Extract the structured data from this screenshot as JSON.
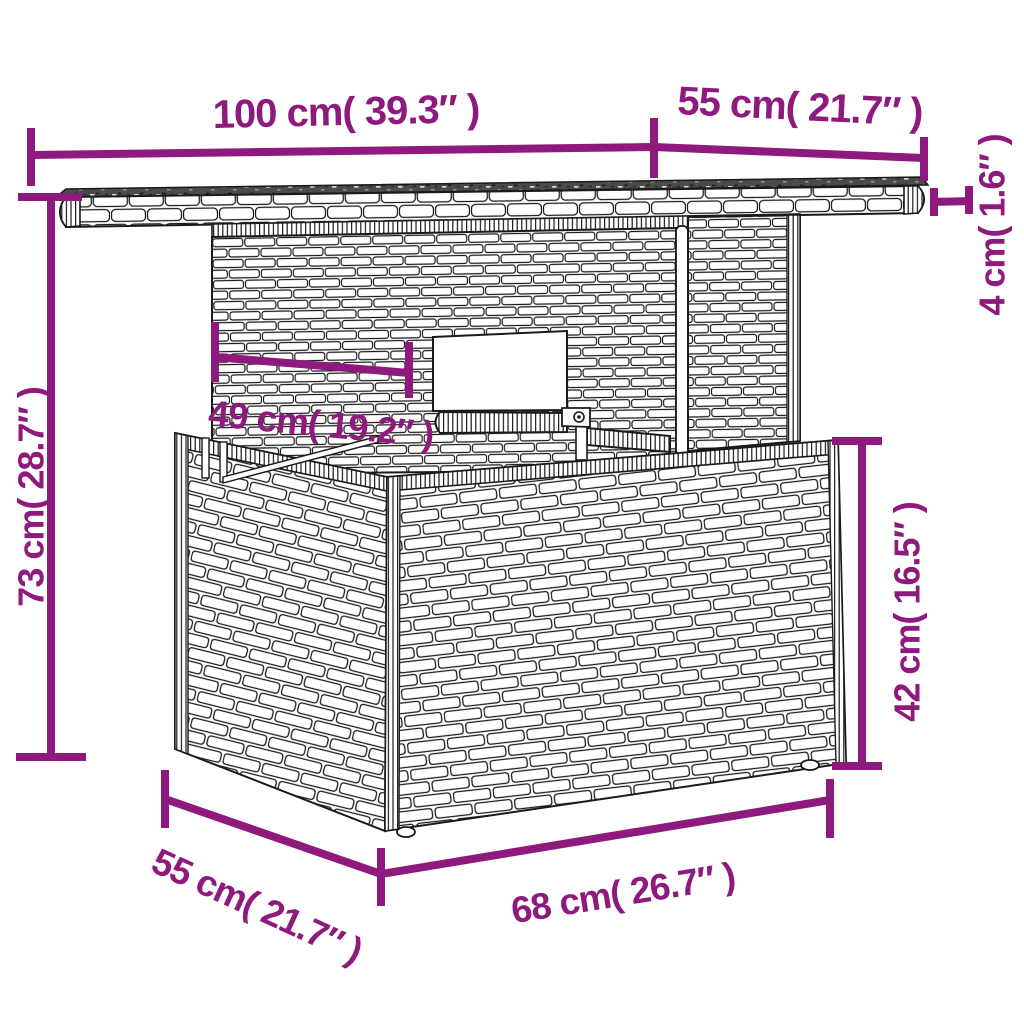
{
  "diagram": {
    "background": "#ffffff",
    "colors": {
      "dimension_accent": "#8E1A7D",
      "outline": "#1a1a1a",
      "tabletop_surface": "#4b4b4b"
    },
    "dimensions": {
      "tabletop_length": "100 cm( 39.3″ )",
      "tabletop_depth": "55 cm( 21.7″ )",
      "tabletop_thickness": "4 cm( 1.6″ )",
      "column_width": "49 cm( 19.2″ )",
      "overall_height": "73 cm( 28.7″ )",
      "base_height": "42 cm( 16.5″ )",
      "base_depth": "55 cm( 21.7″ )",
      "base_length": "68 cm( 26.7″ )"
    }
  }
}
